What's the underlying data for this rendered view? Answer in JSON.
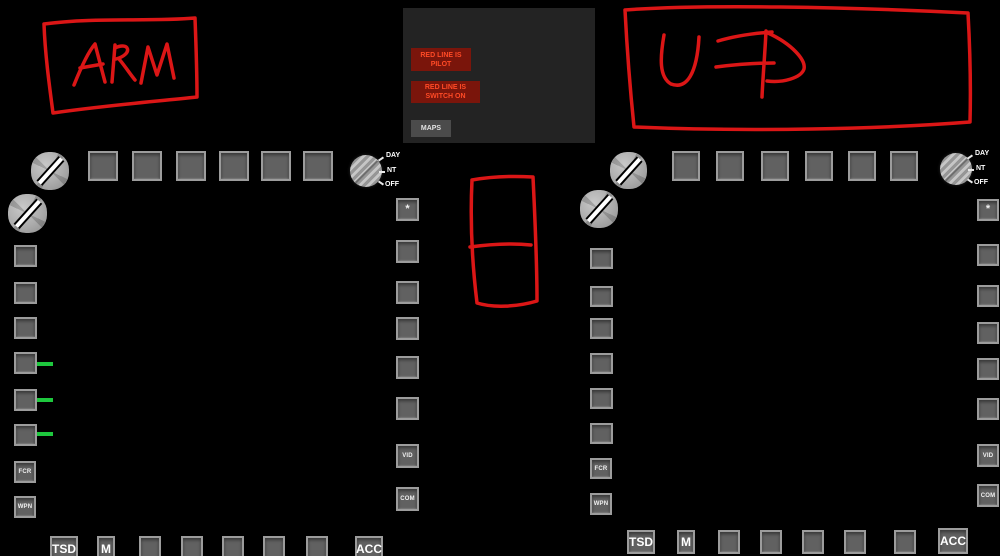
{
  "ufd_panel": {
    "alerts": [
      {
        "line1": "RED LINE IS",
        "line2": "PILOT"
      },
      {
        "line1": "RED LINE IS",
        "line2": "SWITCH ON"
      }
    ],
    "maps_button": "MAPS",
    "alert_bg": "#7a150b",
    "alert_text_color": "#ff4a26"
  },
  "annotations": {
    "color": "#db1616",
    "labels": [
      "ARM",
      "UFD"
    ]
  },
  "mfd_left": {
    "brightness_knob_labels": [
      "DAY",
      "NT",
      "OFF"
    ],
    "star_button": "*",
    "fcr_button": "FCR",
    "wpn_button": "WPN",
    "vid_button": "VID",
    "com_button": "COM",
    "tsd_button": "TSD",
    "m_button": "M",
    "acc_button": "ACC",
    "indicator_line_color": "#1ec83e",
    "indicator_line_count": 3
  },
  "mfd_right": {
    "brightness_knob_labels": [
      "DAY",
      "NT",
      "OFF"
    ],
    "star_button": "*",
    "fcr_button": "FCR",
    "wpn_button": "WPN",
    "vid_button": "VID",
    "com_button": "COM",
    "tsd_button": "TSD",
    "m_button": "M",
    "acc_button": "ACC"
  }
}
